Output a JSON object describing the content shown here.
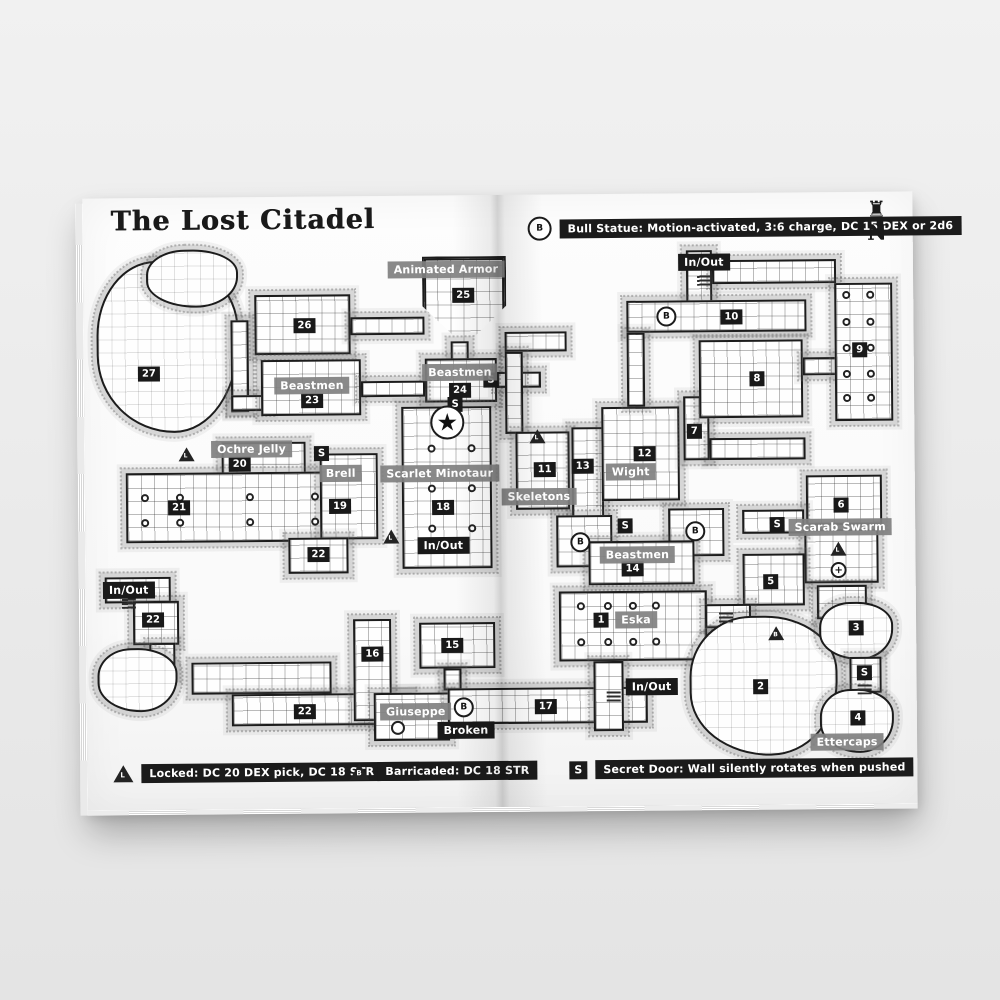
{
  "page": {
    "title": "The Lost Citadel",
    "compass_letter": "N"
  },
  "legend_top": {
    "marker_letter": "B",
    "text": "Bull Statue: Motion-activated, 3:6 charge, DC 15 DEX or 2d6"
  },
  "legend_bottom": [
    {
      "marker_letter": "L",
      "marker_shape": "triangle",
      "text": "Locked: DC 20 DEX pick, DC 18 STR force"
    },
    {
      "marker_letter": "B",
      "marker_shape": "triangle",
      "text": "Barricaded: DC 18 STR"
    },
    {
      "marker_letter": "S",
      "marker_shape": "square",
      "text": "Secret Door: Wall silently rotates when pushed"
    }
  ],
  "colors": {
    "ink": "#1c1c1c",
    "badge_black": "#191919",
    "label_grey": "#808080",
    "page_white": "#fbfbfb",
    "backdrop_grey": "#ececec"
  },
  "map": {
    "rooms": [
      {
        "id": "cave-27",
        "kind": "cave",
        "x": 13,
        "y": 63,
        "w": 142,
        "h": 172
      },
      {
        "id": "cave-27-top",
        "kind": "cave",
        "x": 63,
        "y": 52,
        "w": 92,
        "h": 58
      },
      {
        "id": "room-26",
        "kind": "room",
        "x": 171,
        "y": 98,
        "w": 96,
        "h": 60
      },
      {
        "id": "corridor-26-left",
        "kind": "corr",
        "x": 147,
        "y": 123,
        "w": 18,
        "h": 92
      },
      {
        "id": "corridor-23-left",
        "kind": "corr",
        "x": 147,
        "y": 198,
        "w": 38,
        "h": 16
      },
      {
        "id": "room-23",
        "kind": "room",
        "x": 177,
        "y": 163,
        "w": 100,
        "h": 56
      },
      {
        "id": "corridor-26-25",
        "kind": "corr",
        "x": 267,
        "y": 121,
        "w": 74,
        "h": 18
      },
      {
        "id": "room-25",
        "kind": "pent",
        "x": 339,
        "y": 61,
        "w": 84,
        "h": 90
      },
      {
        "id": "corridor-25-24",
        "kind": "corr",
        "x": 367,
        "y": 146,
        "w": 18,
        "h": 20
      },
      {
        "id": "room-24",
        "kind": "room",
        "x": 341,
        "y": 163,
        "w": 72,
        "h": 44
      },
      {
        "id": "corridor-24-right",
        "kind": "corr",
        "x": 413,
        "y": 177,
        "w": 44,
        "h": 16
      },
      {
        "id": "corridor-23-24",
        "kind": "corr",
        "x": 277,
        "y": 185,
        "w": 64,
        "h": 16
      },
      {
        "id": "hall-18",
        "kind": "hall",
        "x": 317,
        "y": 211,
        "w": 90,
        "h": 162
      },
      {
        "id": "room-20",
        "kind": "room",
        "x": 137,
        "y": 245,
        "w": 84,
        "h": 38
      },
      {
        "id": "hall-21",
        "kind": "hall",
        "x": 41,
        "y": 275,
        "w": 214,
        "h": 70
      },
      {
        "id": "room-19",
        "kind": "room",
        "x": 235,
        "y": 257,
        "w": 58,
        "h": 86
      },
      {
        "id": "corridor-22-a",
        "kind": "corr",
        "x": 203,
        "y": 341,
        "w": 60,
        "h": 36
      },
      {
        "id": "corridor-inout-left",
        "kind": "corr",
        "x": 19,
        "y": 379,
        "w": 66,
        "h": 26
      },
      {
        "id": "corridor-22-b",
        "kind": "corr",
        "x": 47,
        "y": 403,
        "w": 46,
        "h": 44
      },
      {
        "id": "corridor-22-down",
        "kind": "corr",
        "x": 63,
        "y": 445,
        "w": 26,
        "h": 34
      },
      {
        "id": "cave-22",
        "kind": "cave",
        "x": 11,
        "y": 450,
        "w": 80,
        "h": 64
      },
      {
        "id": "corridor-22-c",
        "kind": "corr",
        "x": 105,
        "y": 465,
        "w": 140,
        "h": 32
      },
      {
        "id": "corridor-22-d",
        "kind": "corr",
        "x": 145,
        "y": 497,
        "w": 180,
        "h": 32
      },
      {
        "id": "corridor-16",
        "kind": "corr",
        "x": 267,
        "y": 423,
        "w": 38,
        "h": 102
      },
      {
        "id": "room-15",
        "kind": "room",
        "x": 333,
        "y": 427,
        "w": 76,
        "h": 46
      },
      {
        "id": "corridor-15-down",
        "kind": "corr",
        "x": 357,
        "y": 473,
        "w": 18,
        "h": 22
      },
      {
        "id": "room-giuseppe",
        "kind": "room",
        "x": 287,
        "y": 497,
        "w": 76,
        "h": 48
      },
      {
        "id": "corridor-broken",
        "kind": "corr",
        "x": 361,
        "y": 493,
        "w": 200,
        "h": 36
      },
      {
        "id": "corridor-center-top",
        "kind": "corr",
        "x": 421,
        "y": 137,
        "w": 62,
        "h": 20
      },
      {
        "id": "corridor-center-v",
        "kind": "corr",
        "x": 421,
        "y": 157,
        "w": 18,
        "h": 82
      },
      {
        "id": "room-skeletons",
        "kind": "room",
        "x": 431,
        "y": 237,
        "w": 54,
        "h": 78
      },
      {
        "id": "corridor-13",
        "kind": "corr",
        "x": 487,
        "y": 233,
        "w": 32,
        "h": 94
      },
      {
        "id": "room-wight",
        "kind": "room",
        "x": 517,
        "y": 213,
        "w": 78,
        "h": 94
      },
      {
        "id": "corridor-7",
        "kind": "corr",
        "x": 599,
        "y": 203,
        "w": 26,
        "h": 64
      },
      {
        "id": "corridor-7-right",
        "kind": "corr",
        "x": 625,
        "y": 245,
        "w": 96,
        "h": 22
      },
      {
        "id": "corridor-inout-top",
        "kind": "corr",
        "x": 603,
        "y": 57,
        "w": 26,
        "h": 54
      },
      {
        "id": "corridor-top-right",
        "kind": "corr",
        "x": 629,
        "y": 67,
        "w": 124,
        "h": 24
      },
      {
        "id": "corridor-10",
        "kind": "corr",
        "x": 543,
        "y": 107,
        "w": 180,
        "h": 32
      },
      {
        "id": "corridor-10-down",
        "kind": "corr",
        "x": 543,
        "y": 139,
        "w": 18,
        "h": 74
      },
      {
        "id": "room-8",
        "kind": "room",
        "x": 615,
        "y": 147,
        "w": 104,
        "h": 78
      },
      {
        "id": "corridor-9-8",
        "kind": "corr",
        "x": 719,
        "y": 165,
        "w": 34,
        "h": 18
      },
      {
        "id": "hall-9",
        "kind": "hall",
        "x": 751,
        "y": 91,
        "w": 58,
        "h": 138
      },
      {
        "id": "room-6",
        "kind": "room",
        "x": 721,
        "y": 283,
        "w": 76,
        "h": 50
      },
      {
        "id": "room-scarab-mid",
        "kind": "room",
        "x": 719,
        "y": 337,
        "w": 74,
        "h": 54
      },
      {
        "id": "room-scarab-low",
        "kind": "room",
        "x": 731,
        "y": 393,
        "w": 50,
        "h": 34
      },
      {
        "id": "corridor-s-right",
        "kind": "corr",
        "x": 657,
        "y": 317,
        "w": 62,
        "h": 24
      },
      {
        "id": "room-5",
        "kind": "room",
        "x": 657,
        "y": 361,
        "w": 62,
        "h": 52
      },
      {
        "id": "plaza-b-west",
        "kind": "corr",
        "x": 471,
        "y": 321,
        "w": 56,
        "h": 52
      },
      {
        "id": "plaza-b-east",
        "kind": "corr",
        "x": 583,
        "y": 315,
        "w": 56,
        "h": 48
      },
      {
        "id": "room-14",
        "kind": "room",
        "x": 503,
        "y": 347,
        "w": 106,
        "h": 44
      },
      {
        "id": "hall-1-eska",
        "kind": "hall",
        "x": 473,
        "y": 397,
        "w": 148,
        "h": 70
      },
      {
        "id": "corridor-1-down",
        "kind": "corr",
        "x": 507,
        "y": 467,
        "w": 30,
        "h": 70
      },
      {
        "id": "corridor-1-right",
        "kind": "corr",
        "x": 619,
        "y": 411,
        "w": 46,
        "h": 24
      },
      {
        "id": "cave-2",
        "kind": "cave",
        "x": 603,
        "y": 423,
        "w": 148,
        "h": 140
      },
      {
        "id": "cave-3",
        "kind": "cave",
        "x": 733,
        "y": 410,
        "w": 74,
        "h": 58
      },
      {
        "id": "corridor-s-4",
        "kind": "corr",
        "x": 763,
        "y": 465,
        "w": 32,
        "h": 36
      },
      {
        "id": "cave-4",
        "kind": "cave",
        "x": 733,
        "y": 497,
        "w": 74,
        "h": 64
      }
    ],
    "numbers": [
      {
        "n": "25",
        "x": 380,
        "y": 100
      },
      {
        "n": "26",
        "x": 221,
        "y": 129
      },
      {
        "n": "27",
        "x": 65,
        "y": 176
      },
      {
        "n": "23",
        "x": 228,
        "y": 204
      },
      {
        "n": "24",
        "x": 376,
        "y": 195
      },
      {
        "n": "10",
        "x": 648,
        "y": 124
      },
      {
        "n": "9",
        "x": 776,
        "y": 158
      },
      {
        "n": "8",
        "x": 673,
        "y": 186
      },
      {
        "n": "7",
        "x": 610,
        "y": 238
      },
      {
        "n": "20",
        "x": 155,
        "y": 267
      },
      {
        "n": "21",
        "x": 94,
        "y": 310
      },
      {
        "n": "19",
        "x": 255,
        "y": 310
      },
      {
        "n": "18",
        "x": 358,
        "y": 312
      },
      {
        "n": "11",
        "x": 460,
        "y": 275
      },
      {
        "n": "13",
        "x": 498,
        "y": 272
      },
      {
        "n": "12",
        "x": 560,
        "y": 260
      },
      {
        "n": "6",
        "x": 756,
        "y": 313
      },
      {
        "n": "22",
        "x": 233,
        "y": 358
      },
      {
        "n": "22",
        "x": 67,
        "y": 422
      },
      {
        "n": "22",
        "x": 218,
        "y": 515
      },
      {
        "n": "14",
        "x": 547,
        "y": 375
      },
      {
        "n": "5",
        "x": 685,
        "y": 389
      },
      {
        "n": "1",
        "x": 515,
        "y": 426
      },
      {
        "n": "2",
        "x": 674,
        "y": 494
      },
      {
        "n": "3",
        "x": 770,
        "y": 436
      },
      {
        "n": "4",
        "x": 771,
        "y": 526
      },
      {
        "n": "16",
        "x": 286,
        "y": 458
      },
      {
        "n": "15",
        "x": 366,
        "y": 450
      },
      {
        "n": "17",
        "x": 459,
        "y": 512
      }
    ],
    "grey_labels": [
      {
        "text": "Animated Armor",
        "x": 363,
        "y": 74
      },
      {
        "text": "Beastmen",
        "x": 228,
        "y": 189
      },
      {
        "text": "Beastmen",
        "x": 376,
        "y": 177
      },
      {
        "text": "Ochre Jelly",
        "x": 167,
        "y": 252
      },
      {
        "text": "Brell",
        "x": 256,
        "y": 277
      },
      {
        "text": "Scarlet Minotaur",
        "x": 355,
        "y": 278
      },
      {
        "text": "Skeletons",
        "x": 454,
        "y": 302
      },
      {
        "text": "Wight",
        "x": 546,
        "y": 278
      },
      {
        "text": "Scarab Swarm",
        "x": 755,
        "y": 335
      },
      {
        "text": "Beastmen",
        "x": 552,
        "y": 361
      },
      {
        "text": "Eska",
        "x": 550,
        "y": 426
      },
      {
        "text": "Giuseppe",
        "x": 329,
        "y": 516
      },
      {
        "text": "Ettercaps",
        "x": 760,
        "y": 550
      }
    ],
    "black_labels": [
      {
        "text": "In/Out",
        "x": 621,
        "y": 69
      },
      {
        "text": "In/Out",
        "x": 358,
        "y": 350
      },
      {
        "text": "In/Out",
        "x": 43,
        "y": 392
      },
      {
        "text": "In/Out",
        "x": 565,
        "y": 493
      },
      {
        "text": "Broken",
        "x": 379,
        "y": 535
      }
    ],
    "s_markers": [
      {
        "x": 407,
        "y": 185
      },
      {
        "x": 371,
        "y": 209
      },
      {
        "x": 237,
        "y": 257
      },
      {
        "x": 540,
        "y": 332
      },
      {
        "x": 692,
        "y": 332
      },
      {
        "x": 778,
        "y": 481
      }
    ],
    "b_markers": [
      {
        "x": 583,
        "y": 123
      },
      {
        "x": 495,
        "y": 348
      },
      {
        "x": 610,
        "y": 338
      },
      {
        "x": 377,
        "y": 512
      }
    ],
    "triangle_markers": [
      {
        "letter": "L",
        "x": 102,
        "y": 258
      },
      {
        "letter": "L",
        "x": 453,
        "y": 243
      },
      {
        "letter": "L",
        "x": 753,
        "y": 358
      },
      {
        "letter": "L",
        "x": 306,
        "y": 342
      },
      {
        "letter": "B",
        "x": 690,
        "y": 442
      }
    ],
    "star_marker": {
      "x": 363,
      "y": 227
    },
    "cross_marker": {
      "x": 753,
      "y": 378
    },
    "pillars": [
      [
        347,
        253
      ],
      [
        387,
        253
      ],
      [
        347,
        293
      ],
      [
        387,
        293
      ],
      [
        347,
        333
      ],
      [
        387,
        333
      ],
      [
        60,
        300
      ],
      [
        95,
        300
      ],
      [
        165,
        300
      ],
      [
        230,
        300
      ],
      [
        60,
        325
      ],
      [
        95,
        325
      ],
      [
        165,
        325
      ],
      [
        230,
        325
      ],
      [
        495,
        412
      ],
      [
        522,
        412
      ],
      [
        547,
        412
      ],
      [
        570,
        412
      ],
      [
        495,
        448
      ],
      [
        522,
        448
      ],
      [
        547,
        448
      ],
      [
        570,
        448
      ],
      [
        763,
        103
      ],
      [
        787,
        103
      ],
      [
        763,
        130
      ],
      [
        787,
        130
      ],
      [
        763,
        156
      ],
      [
        787,
        156
      ],
      [
        763,
        182
      ],
      [
        787,
        182
      ],
      [
        763,
        206
      ],
      [
        787,
        206
      ]
    ],
    "wells": [
      [
        311,
        532
      ]
    ],
    "stairs": [
      [
        621,
        87
      ],
      [
        43,
        405
      ],
      [
        527,
        502
      ],
      [
        778,
        497
      ],
      [
        640,
        424
      ]
    ]
  }
}
